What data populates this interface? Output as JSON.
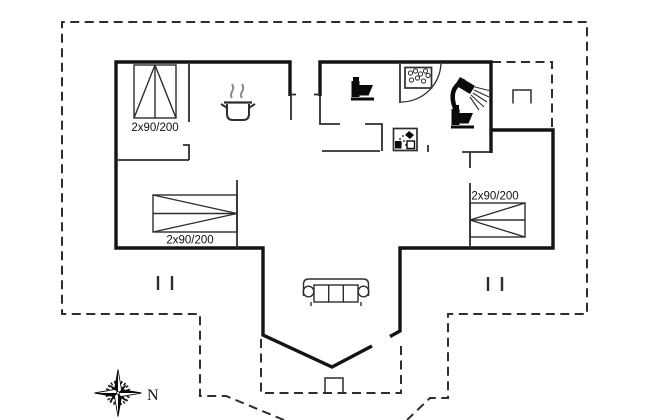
{
  "document": {
    "type": "holiday-house-floor-plan"
  },
  "labels": {
    "beds": [
      {
        "label": "2x90/200"
      },
      {
        "label": "2x90/200"
      },
      {
        "label": "2x90/200"
      }
    ],
    "compass_north": "N"
  },
  "colors": {
    "wall": "#141414",
    "thin-line": "#2e2e2e",
    "dash-line": "#2e2e2e",
    "text": "#111111",
    "steam": "#8a8a8a",
    "background": "#ffffff"
  },
  "icons": {
    "stove": "pot-with-steam-icon",
    "toilet_left": "toilet-icon",
    "toilet_right": "toilet-icon",
    "shower": "shower-head-icon",
    "shower_cabin": "shower-cabin-icon",
    "washbasin": "washbasin-bubbles-icon",
    "sofa": "sofa-icon",
    "compass": "compass-rose-icon",
    "beds": "double-bed-icon",
    "steps": "entrance-step-marker",
    "posts": "terrace-post-marker"
  }
}
